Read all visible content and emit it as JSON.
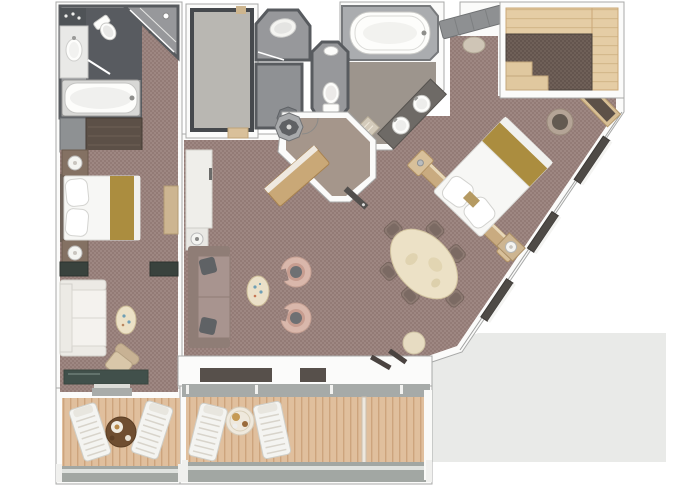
{
  "page": {
    "background": "#ffffff",
    "kind": "suite-floor-plan"
  },
  "palette": {
    "carpet": "#9e8782",
    "carpet2": "#937b76",
    "closet_carpet": "#6f6058",
    "closet_carpet2": "#64554e",
    "wall": "#fbfbfa",
    "wall_edge": "#a8a9a8",
    "partition": "#585b5f",
    "bath_floor": "#97989b",
    "bath_floor_dark": "#585b60",
    "master_bath_floor": "#9d958d",
    "deck": "#e0bf9d",
    "deck_line": "#cda47d",
    "railing": "#a2a7a3",
    "railing_hi": "#dfe2df",
    "wood_light": "#e5cda5",
    "wood_console": "#c9a877",
    "wood_head": "#c9ab80",
    "gold": "#ab8d3f",
    "sofa": "#a8948f",
    "sofa_dark": "#8f7d76",
    "chair_pink": "#d9b7ab",
    "chair_tan": "#d9c7a9",
    "dining_chair": "#8d7a72",
    "table_cream": "#ece1c6",
    "white_furn": "#f4f4f1",
    "glass_dark": "#41504b",
    "window_dark": "#4e4a46",
    "backdrop": "#e9eae8",
    "fixture": "#fdfdfb",
    "fixture_stroke": "#c9c9c6",
    "closet_floor": "#b9b7b2"
  },
  "floorplan": {
    "rooms": [
      {
        "id": "guest-bathroom",
        "furniture": [
          "vanity-sink",
          "toilet",
          "bathtub",
          "corner-shower",
          "counter"
        ]
      },
      {
        "id": "bedroom-two",
        "furniture": [
          "bed",
          "nightstand",
          "nightstand",
          "wardrobe",
          "dresser-bench",
          "loveseat",
          "side-table",
          "oval-table",
          "armchair",
          "sliding-door"
        ]
      },
      {
        "id": "veranda-bedroom-two",
        "furniture": [
          "lounger",
          "lounger",
          "round-table",
          "railing"
        ]
      },
      {
        "id": "walk-in-closet",
        "furniture": [
          "threshold"
        ]
      },
      {
        "id": "shower-room",
        "furniture": [
          "shower-tray"
        ]
      },
      {
        "id": "utility-room",
        "furniture": [
          "corner-shower"
        ]
      },
      {
        "id": "toilet-room",
        "furniture": [
          "toilet",
          "hand-basin"
        ]
      },
      {
        "id": "master-bathroom",
        "furniture": [
          "whirlpool-tub",
          "double-sink-vanity",
          "towel-shelf"
        ]
      },
      {
        "id": "entrance-foyer",
        "furniture": [
          "console-table",
          "column",
          "door"
        ]
      },
      {
        "id": "living-room",
        "furniture": [
          "wall-console",
          "lamp-table",
          "sofa",
          "coffee-table",
          "tub-chair",
          "tub-chair"
        ]
      },
      {
        "id": "dining-area",
        "furniture": [
          "dining-table",
          "dining-chair",
          "dining-chair",
          "dining-chair",
          "dining-chair",
          "dining-chair",
          "dining-chair",
          "stool"
        ]
      },
      {
        "id": "master-bedroom",
        "furniture": [
          "king-bed",
          "headboard-wall",
          "nightstand",
          "desk",
          "desk-chair",
          "dressing-bench",
          "pouf",
          "window",
          "window",
          "window"
        ]
      },
      {
        "id": "master-walk-in-wardrobe",
        "furniture": [
          "wardrobe-unit",
          "shelf-unit"
        ]
      },
      {
        "id": "veranda-main",
        "furniture": [
          "lounger",
          "lounger",
          "round-table",
          "railing",
          "divider"
        ]
      }
    ]
  }
}
